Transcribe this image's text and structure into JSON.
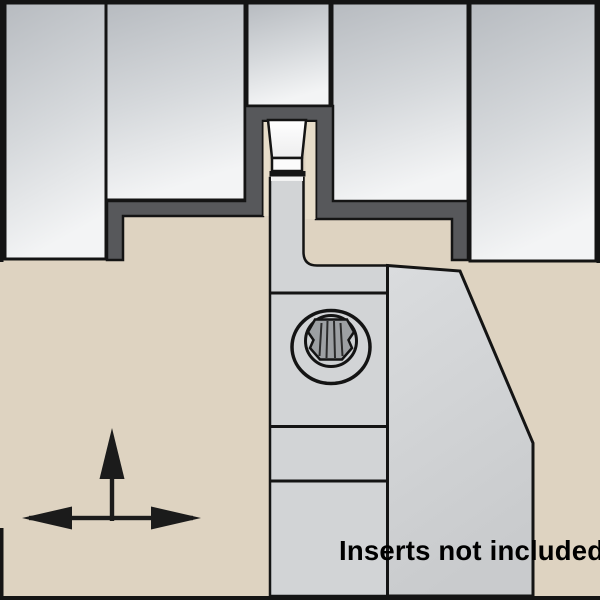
{
  "caption": {
    "text": "Inserts not included"
  },
  "colors": {
    "background": "#ded3c1",
    "cut_zone": "#57585b",
    "blade": "#d2d4d6",
    "body": "#d2d4d6",
    "insert_lower": "#fbfbfb",
    "insert_sliver": "#f2f2f2",
    "clearance_strip": "#e7ddc9",
    "screw_well": "#ced1d3",
    "torx": "#9da0a3",
    "outline": "#141414",
    "arrow": "#1b1b1b",
    "caption_color": "#000000"
  },
  "icons": {
    "feed_arrows": "plunge-up-and-traverse-left-right-arrows",
    "screw": "torx-clamp-screw"
  }
}
